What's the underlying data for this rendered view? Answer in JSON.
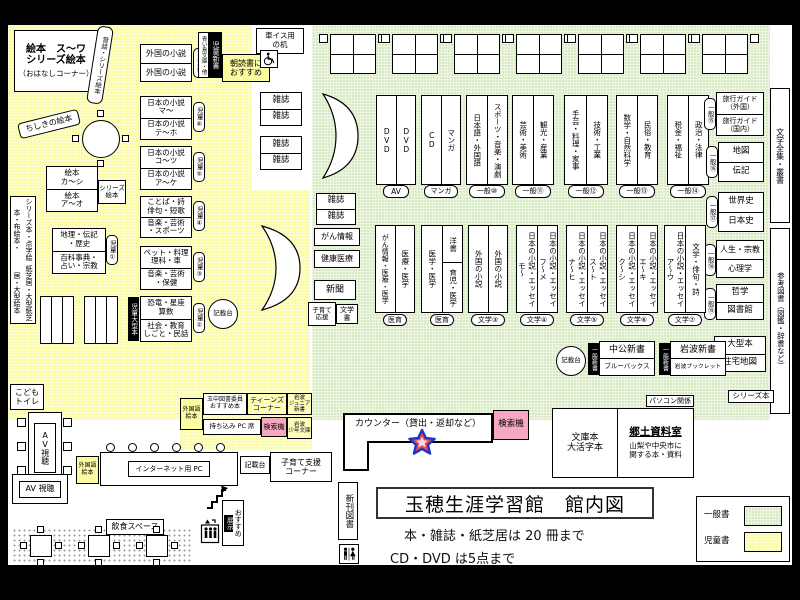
{
  "zone_colors": {
    "children": "#FBFBA0",
    "general": "#D9EBC4",
    "search_machine": "#F5A8BF"
  },
  "title_block": {
    "title": "玉穂生涯学習館　館内図",
    "rule1": "本・雑誌・紙芝居は 20 冊まで",
    "rule2": "CD・DVD は5点まで"
  },
  "legend": {
    "general": "一般書",
    "children": "児童書"
  },
  "kids": {
    "ehon_corner": {
      "l1": "絵本　ス～ワ",
      "l2": "シリーズ絵本",
      "l3": "（おはなしコーナー）"
    },
    "mukashi": "昔話・シリーズ絵本",
    "chishiki": "ちしきの絵本",
    "tall_left_1": "シリーズ本・点字絵本・布絵本・",
    "tall_left_2": "紙芝居・大型紙芝居・大型絵本",
    "shelf7": {
      "c1": "外国の小説",
      "c2": "外国の小説",
      "badge": "児童⑦"
    },
    "shelf6": {
      "c1a": "日本の小説",
      "c1b": "マ～",
      "c2a": "日本の小説",
      "c2b": "テ～ホ",
      "badge": "児童⑥"
    },
    "shelf5": {
      "c1a": "日本の小説",
      "c1b": "コ～ツ",
      "c2a": "日本の小説",
      "c2b": "ア～ケ",
      "badge": "児童⑤"
    },
    "shelf4": {
      "c1a": "ことば・詩",
      "c1b": "俳句・短歌",
      "c2a": "音楽・芸術",
      "c2b": "・スポーツ",
      "badge": "児童④"
    },
    "shelf3": {
      "c1a": "ペット・料理",
      "c1b": "理科・車",
      "c2a": "音楽・芸術",
      "c2b": "・保健",
      "badge": "児童③"
    },
    "shelf2": {
      "c1a": "恐竜・星座",
      "c1b": "算数",
      "c2a": "社会・教育",
      "c2b": "しごと・民話",
      "badge": "児童②",
      "side": "児童大型本"
    },
    "shelf1": {
      "c1a": "地理・伝記",
      "c1b": "・歴史",
      "c2a": "百科事典・",
      "c2b": "占い・宗教",
      "badge": "児童①"
    },
    "ehon_ka": {
      "c1a": "絵本",
      "c1b": "カ～シ",
      "c2a": "絵本",
      "c2b": "ア～オ",
      "side1": "シリーズ",
      "side2": "絵本"
    },
    "toilet1": "こども",
    "toilet2": "トイレ",
    "shinsho_tag": "児童新書",
    "shinsho_sub": "青い鳥文庫・他",
    "asadoku1": "朝読書に",
    "asadoku2": "おすすめ",
    "kisaidai": "記載台"
  },
  "corridor": {
    "wheel1": "車イス用",
    "wheel2": "の机",
    "mag": "雑誌"
  },
  "top_pairs": [
    {
      "s1": "DVD",
      "s2": "DVD",
      "tag": "AV"
    },
    {
      "s1": "CD",
      "s2": "マンガ",
      "tag": "マンガ"
    },
    {
      "s1": "日本語・外国語",
      "s2": "スポーツ・音楽・演劇",
      "tag": "一般⑩"
    },
    {
      "s1": "芸術・美術",
      "s2": "観光・産業",
      "tag": "一般⑪"
    },
    {
      "s1": "手芸・料理・家事",
      "s2": "技術・工業",
      "tag": "一般⑫"
    },
    {
      "s1": "数学・自然科学",
      "s2": "民俗・教育",
      "tag": "一般⑬"
    },
    {
      "s1": "税金・福祉",
      "s2": "政治・法律",
      "tag": "一般⑭"
    }
  ],
  "right_stacks": {
    "travel": {
      "c1a": "旅行ガイド",
      "c1b": "（外国）",
      "c2a": "旅行ガイド",
      "c2b": "（国内）",
      "tag": "一般⑮"
    },
    "mapbio": {
      "c1": "地図",
      "c2": "伝記",
      "tag": "一般⑯"
    },
    "history": {
      "c1": "世界史",
      "c2": "日本史",
      "tag": "一般⑰"
    },
    "life": {
      "c1": "人生・宗教",
      "c2": "心理学",
      "tag": "一般⑱"
    },
    "phil": {
      "c1": "哲学",
      "c2": "図書館",
      "tag": "一般⑲"
    },
    "large": {
      "c1": "大型本",
      "c2": "住宅地図"
    }
  },
  "right_wall": {
    "top": "文学全集・叢書",
    "bottom": "参考図書（図鑑・辞書など）",
    "series": "シリーズ本",
    "pc": "パソコン関係"
  },
  "green_left": {
    "mag": "雑誌",
    "gan": "がん情報",
    "kenko": "健康医療",
    "news": "新聞",
    "kosodate1": "子育て",
    "kosodate2": "応援",
    "bungaku": "文学書"
  },
  "mid_pairs": [
    {
      "s1": "がん情報・医療・医学",
      "s2": "医療・医学",
      "tag": "医育"
    },
    {
      "s1": "医学・医学",
      "s2top": "洋書",
      "s2bot": "育児・医学",
      "tag": "医育"
    },
    {
      "s1": "外国の小説",
      "s2": "外国の小説",
      "tag": "文学③"
    },
    {
      "s1": "日本の小説・エッセイ",
      "s1b": "モ～",
      "s2": "日本の小説・エッセイ",
      "s2b": "フ～メ",
      "tag": "文学④"
    },
    {
      "s1": "日本の小説・エッセイ",
      "s1b": "ナ～ヒ",
      "s2": "日本の小説・エッセイ",
      "s2b": "ス～ト",
      "tag": "文学⑤"
    },
    {
      "s1": "日本の小説・エッセイ",
      "s1b": "ク～シ",
      "s2": "日本の小説・エッセイ",
      "s2b": "エ～キ",
      "tag": "文学⑥"
    },
    {
      "s1": "日本の小説・エッセイ",
      "s1b": "ア～ウ",
      "s2": "文学・俳句・詩",
      "tag": "文学⑦"
    }
  ],
  "newbooks": {
    "kisaidai": "記載台",
    "tag1": "一般新書",
    "c1": "中公新書",
    "c2": "ブルーバックス",
    "tag2": "一般新書",
    "c3": "岩波新書",
    "c4": "岩波ブックレット"
  },
  "counter": {
    "label": "カウンター（貸出・返却など）",
    "kensaku": "検索機"
  },
  "kyodo": {
    "b1": "文庫本",
    "b2": "大活字本",
    "title": "郷土資料室",
    "d1": "山梨や中央市に",
    "d2": "関する本・資料"
  },
  "teens": {
    "g1": "外国語",
    "g2": "絵本",
    "t1": "玉中図書委員",
    "t2": "おすすめ本",
    "n1": "ティーンズ",
    "n2": "コーナー",
    "j1": "岩波",
    "j2": "ジュニア新書",
    "pc": "持ち込み PC 席",
    "kensaku": "検索機",
    "s1": "岩波",
    "s2": "少年文庫"
  },
  "internet": {
    "g1": "外国語",
    "g2": "絵本",
    "label": "インターネット用 PC",
    "kisaidai": "記載台",
    "k1": "子育て支援",
    "k2": "コーナー"
  },
  "av": {
    "vertical": "AV視聴",
    "box": "AV 視聴"
  },
  "misc": {
    "inshoku": "飲食スペース",
    "osusume": "おすすめ",
    "tenji": "展示",
    "shinkan": "新刊図書"
  }
}
